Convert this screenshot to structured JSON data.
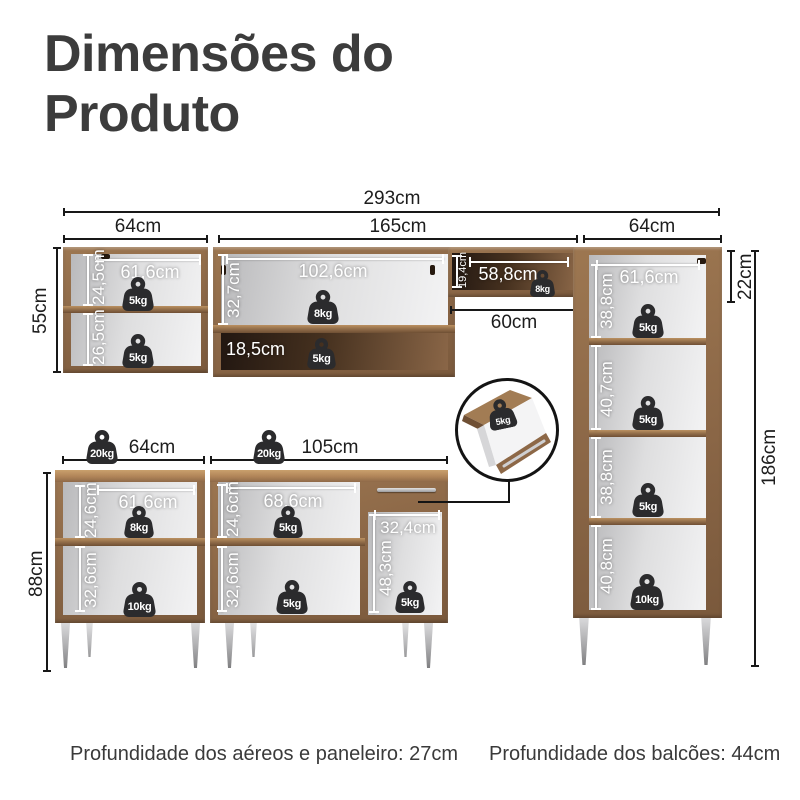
{
  "title": "Dimensões do Produto",
  "footer": {
    "aereos": "Profundidade dos aéreos e paneleiro: 27cm",
    "balcoes": "Profundidade dos balcões: 44cm"
  },
  "dimensions": {
    "total_width": "293cm",
    "upper_left_width": "64cm",
    "upper_middle_width": "165cm",
    "upper_right_width": "64cm",
    "upper_left_height": "55cm",
    "upper_left_inner_width": "61,6cm",
    "upper_left_top_section": "24,5cm",
    "upper_left_bottom_section": "26,5cm",
    "upper_middle_inner_width": "102,6cm",
    "upper_middle_section": "32,7cm",
    "upper_middle_shelf": "18,5cm",
    "mini_shelf_height": "19,4cm",
    "mini_shelf_width": "58,8cm",
    "stove_gap": "60cm",
    "tall_top_section": "22cm",
    "tall_height": "186cm",
    "tall_inner_width": "61,6cm",
    "tall_section1": "38,8cm",
    "tall_section2": "40,7cm",
    "tall_section3": "38,8cm",
    "tall_section4": "40,8cm",
    "base_height": "88cm",
    "base1_width": "64cm",
    "base1_inner_width": "61,6cm",
    "base1_top_section": "24,6cm",
    "base1_bottom_section": "32,6cm",
    "base2_width": "105cm",
    "base2_inner_width": "68,6cm",
    "base2_top_section": "24,6cm",
    "base2_bottom_section": "32,6cm",
    "base2_compartment_width": "32,4cm",
    "base2_compartment_height": "48,3cm"
  },
  "weights": {
    "upper_left_top": "5kg",
    "upper_left_bottom": "5kg",
    "upper_middle": "8kg",
    "upper_middle_shelf": "5kg",
    "mini_shelf": "8kg",
    "tall_s1": "5kg",
    "tall_s2": "5kg",
    "tall_s3": "5kg",
    "tall_s4": "10kg",
    "base1_load": "20kg",
    "base2_load": "20kg",
    "base1_top": "8kg",
    "base1_bottom": "10kg",
    "base2_top": "5kg",
    "base2_bottom": "5kg",
    "base2_right": "5kg",
    "drawer_detail": "5kg"
  }
}
